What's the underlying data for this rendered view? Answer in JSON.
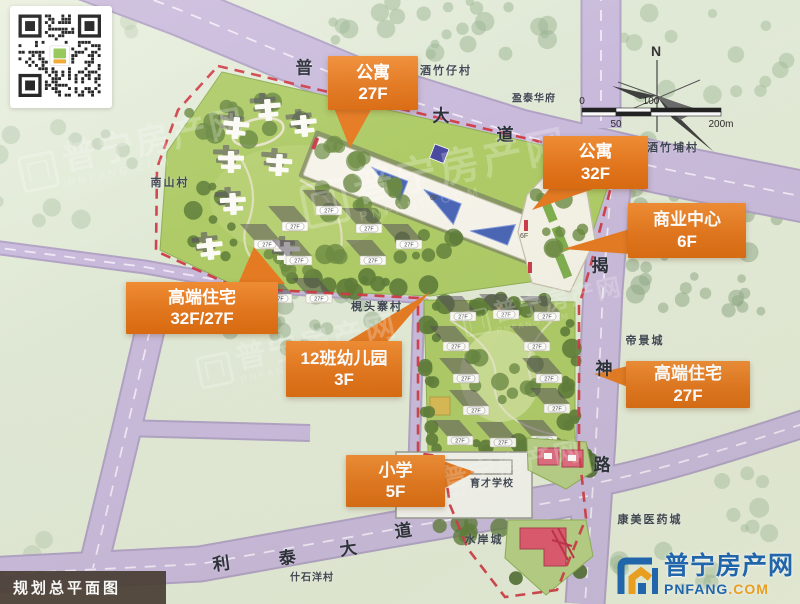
{
  "meta": {
    "title": "规划总平面图"
  },
  "logo": {
    "name": "普宁房产网",
    "domain": "PNFANG",
    "tld": ".COM"
  },
  "watermark": {
    "name": "普宁房产网",
    "domain": "PNFANG.COM"
  },
  "compass": {
    "north": "N"
  },
  "scalebar": {
    "zero": "0",
    "fifty": "50",
    "hundred": "100",
    "twohundred": "200m"
  },
  "roads": {
    "pu_avenue": {
      "chars": [
        "普",
        "大",
        "道"
      ]
    },
    "jieshen_road": {
      "chars": [
        "揭",
        "神",
        "路"
      ]
    },
    "litai_avenue": {
      "chars": [
        "利",
        "泰",
        "大",
        "道"
      ]
    }
  },
  "places": {
    "jiuzhuzai": "酒竹仔村",
    "yingtai": "盈泰华府",
    "jiuzhubu": "酒竹埔村",
    "nanshan": "南山村",
    "jiantouzhai": "梘头寨村",
    "dijing": "帝景城",
    "yucai": "育才学校",
    "kangmei": "康美医药城",
    "shuian": "水岸城",
    "shishiyang": "什石洋村"
  },
  "callouts": [
    {
      "id": "apartment-27f",
      "line1": "公寓",
      "line2": "27F"
    },
    {
      "id": "apartment-32f",
      "line1": "公寓",
      "line2": "32F"
    },
    {
      "id": "commercial-center-6f",
      "line1": "商业中心",
      "line2": "6F"
    },
    {
      "id": "luxury-residence-32f-27f",
      "line1": "高端住宅",
      "line2": "32F/27F"
    },
    {
      "id": "kindergarten-3f",
      "line1": "12班幼儿园",
      "line2": "3F"
    },
    {
      "id": "luxury-residence-27f",
      "line1": "高端住宅",
      "line2": "27F"
    },
    {
      "id": "primary-school-5f",
      "line1": "小学",
      "line2": "5F"
    }
  ],
  "marks": {
    "tower": "27F",
    "commercial": "6F"
  }
}
